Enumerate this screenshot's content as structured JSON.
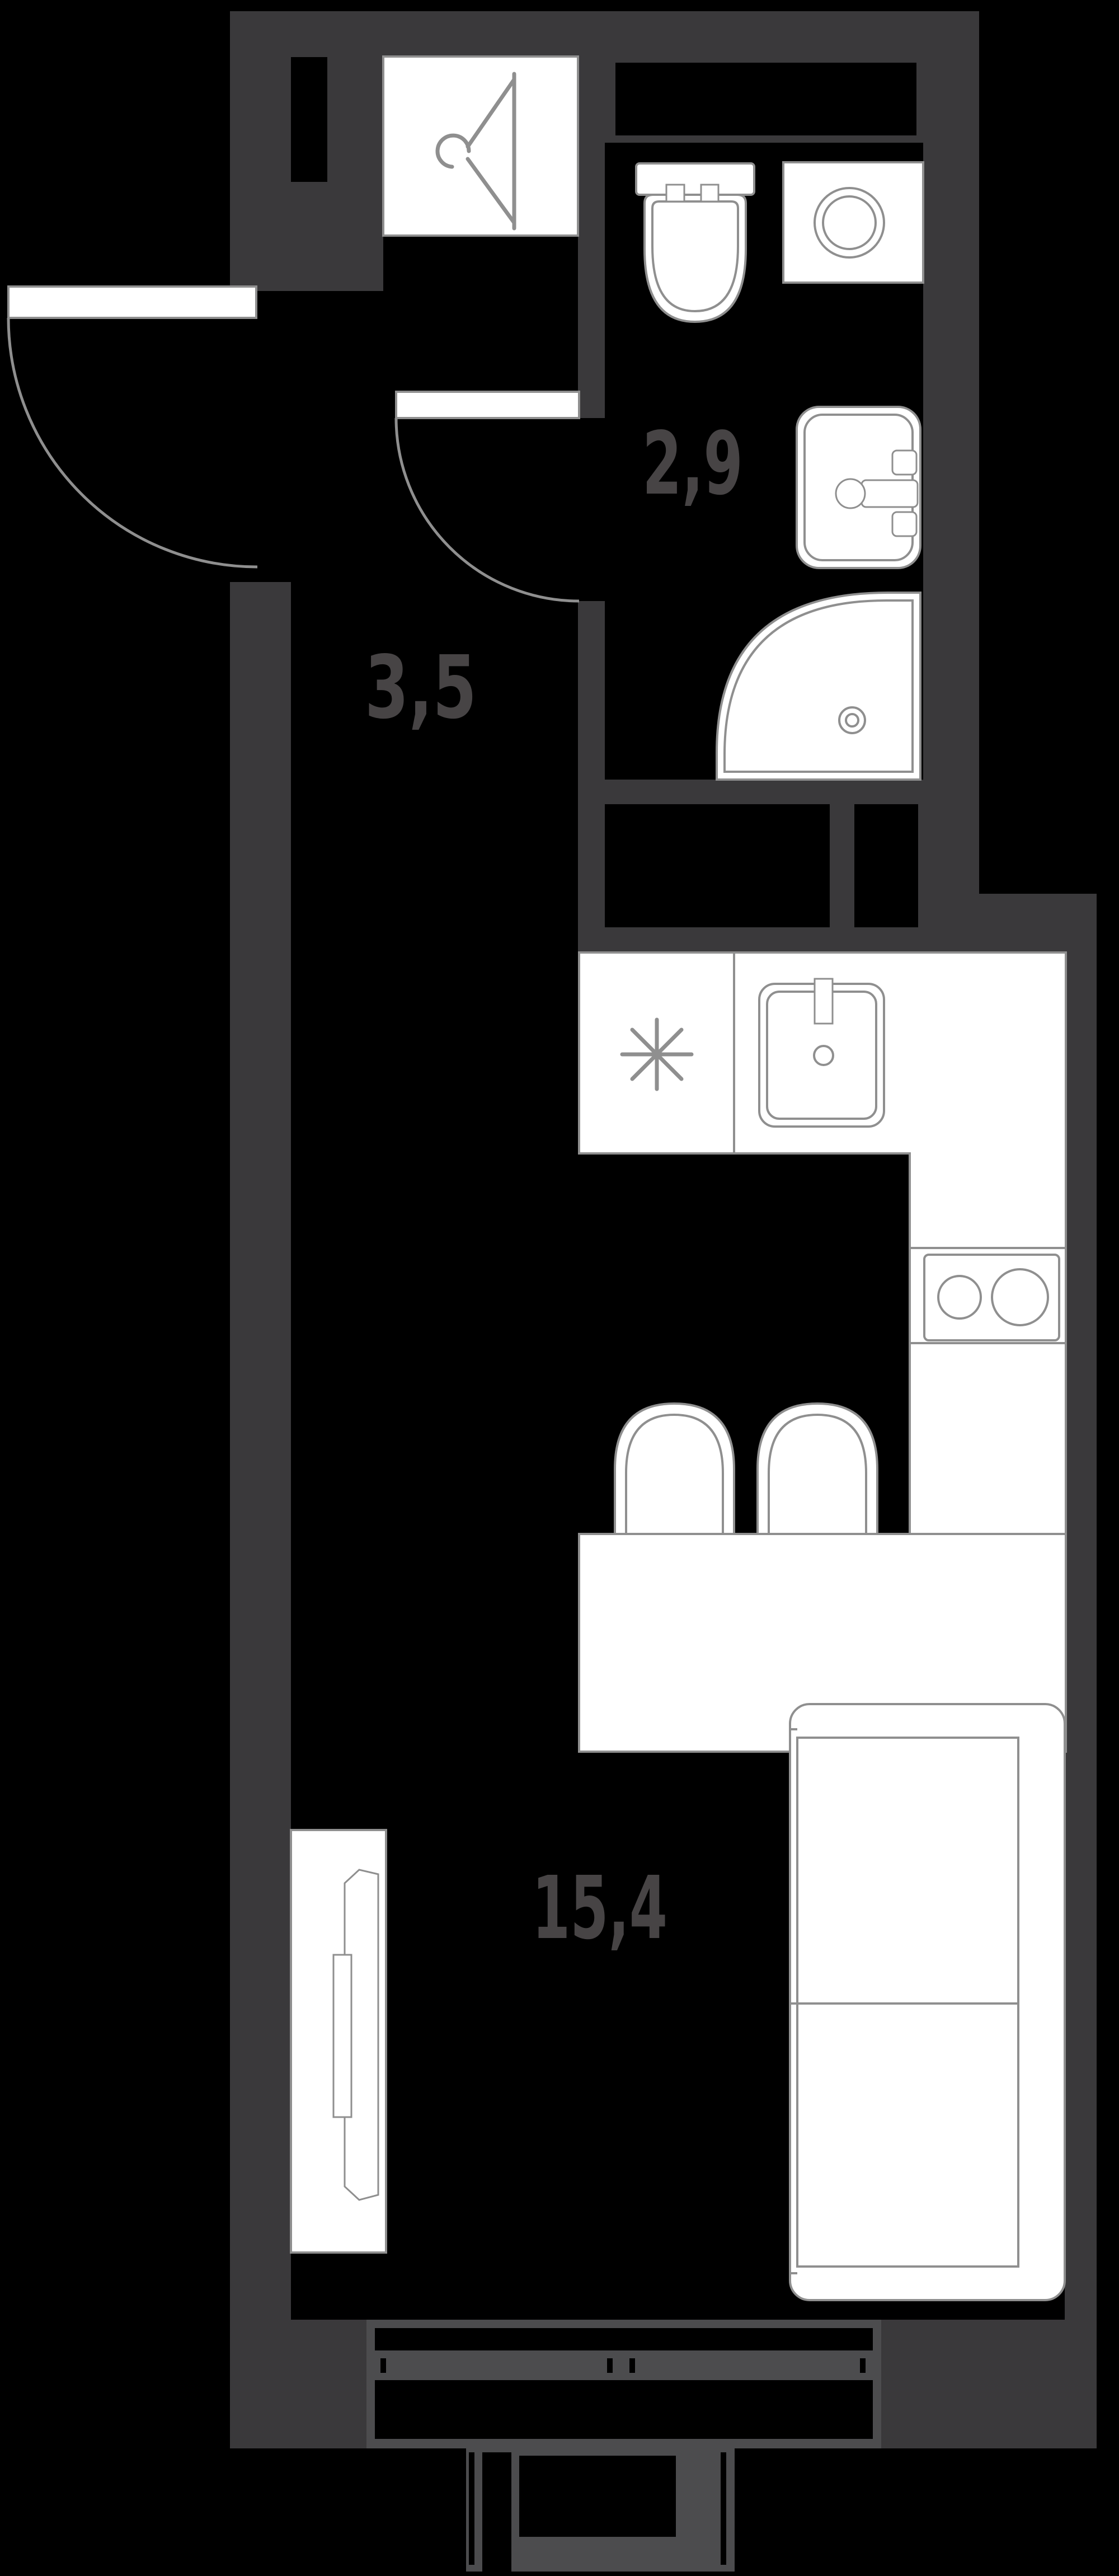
{
  "rooms": [
    {
      "name": "bathroom",
      "area": "2,9"
    },
    {
      "name": "hallway",
      "area": "3,5"
    },
    {
      "name": "living-kitchen",
      "area": "15,4"
    }
  ],
  "fixtures": [
    "coat-hanger",
    "toilet",
    "washing-machine",
    "washbasin",
    "shower",
    "ventilation-shaft",
    "kitchen-counter",
    "kitchen-sink",
    "refrigerator-symbol",
    "cooktop",
    "bar-stool",
    "bar-table",
    "sofa",
    "wardrobe",
    "entrance-door",
    "bathroom-door",
    "window",
    "balcony"
  ],
  "colors": {
    "bg": "#000000",
    "wall": "#3A393B",
    "label": "#474445",
    "fixture": "#FFFFFF",
    "outline": "#8F8F8F",
    "frame": "#4C4C4E"
  }
}
